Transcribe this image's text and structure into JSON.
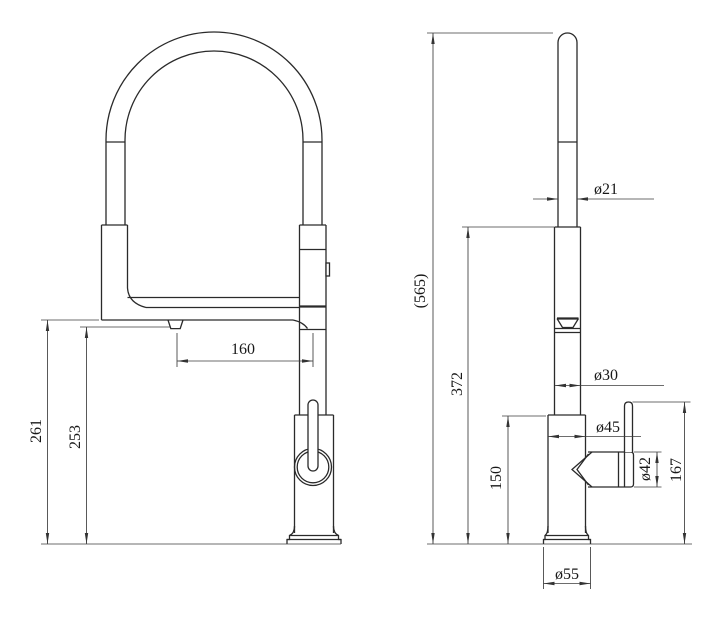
{
  "drawing": {
    "background": "#ffffff",
    "line_color": "#2a2a2a",
    "front_view": {
      "name": "Front view",
      "dims": {
        "reach": "160",
        "height_to_spout": "261",
        "height_to_outlet": "253"
      }
    },
    "side_view": {
      "name": "Side view",
      "dims": {
        "overall_height": "(565)",
        "spout_outlet_height": "372",
        "body_height": "150",
        "handle_top_height": "167",
        "hose_diameter": "ø21",
        "spout_diameter": "ø30",
        "body_diameter": "ø45",
        "handle_diameter": "ø42",
        "base_diameter": "ø55"
      }
    }
  }
}
